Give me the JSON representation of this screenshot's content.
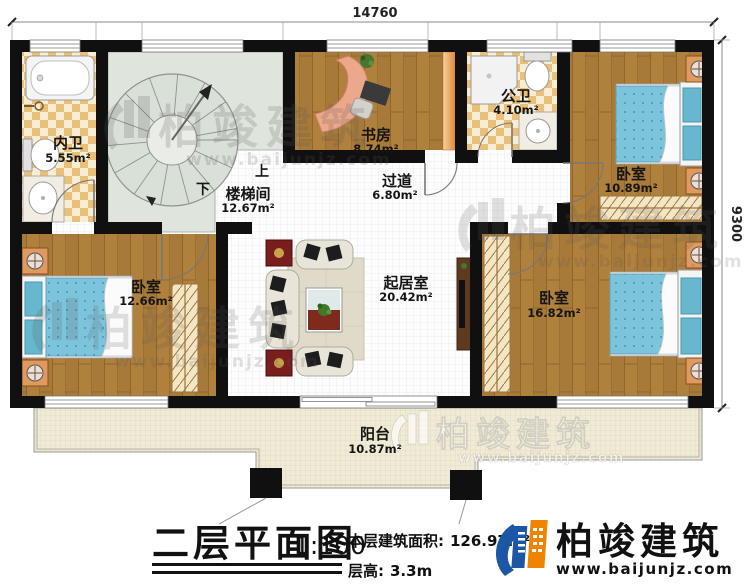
{
  "dimensions": {
    "top": "14760",
    "right": "9300"
  },
  "rooms": [
    {
      "id": "neiwei",
      "name": "内卫",
      "area": "5.55m²"
    },
    {
      "id": "loutijian",
      "name": "楼梯间",
      "area": "12.67m²"
    },
    {
      "id": "shufang",
      "name": "书房",
      "area": "8.74m²"
    },
    {
      "id": "gongwei",
      "name": "公卫",
      "area": "4.10m²"
    },
    {
      "id": "guodao",
      "name": "过道",
      "area": "6.80m²"
    },
    {
      "id": "woshi_top",
      "name": "卧室",
      "area": "10.89m²"
    },
    {
      "id": "woshi_left",
      "name": "卧室",
      "area": "12.66m²"
    },
    {
      "id": "qijushi",
      "name": "起居室",
      "area": "20.42m²"
    },
    {
      "id": "woshi_right",
      "name": "卧室",
      "area": "16.82m²"
    },
    {
      "id": "yangtai",
      "name": "阳台",
      "area": "10.87m²"
    }
  ],
  "stair": {
    "up": "上",
    "down": "下"
  },
  "title_block": {
    "title": "二层平面图",
    "scale": "1:100",
    "area_label": "本层建筑面积:",
    "area_value": "126.97m²",
    "height_label": "层高:",
    "height_value": "3.3m"
  },
  "branding": {
    "name": "柏竣建筑",
    "url": "www.baijunjz.com"
  },
  "colors": {
    "wall": "#101010",
    "wood_floor": "#b0803d",
    "tile": "#e9c07a",
    "stair_room": "#dfe5dd",
    "balcony": "#f0ebd6",
    "bed_blue": "#7cc4dc",
    "nightstand_orange": "#e09a60",
    "brand_blue": "#1c57a5",
    "brand_orange": "#f08300"
  }
}
